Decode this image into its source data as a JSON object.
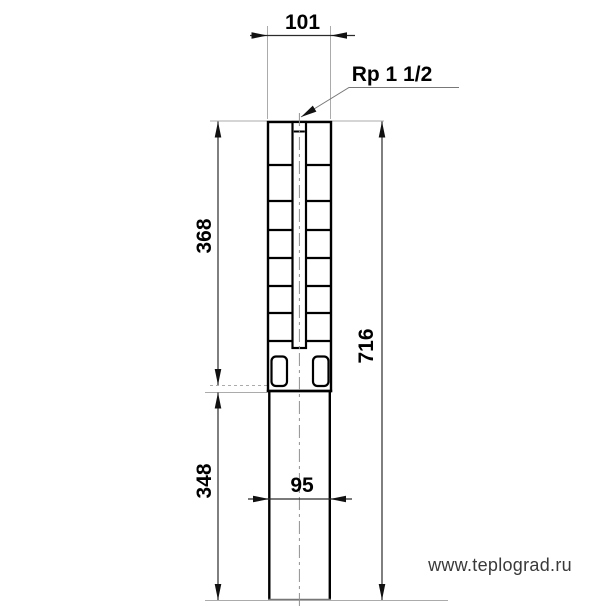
{
  "labels": {
    "top_width": "101",
    "connection": "Rp 1 1/2",
    "upper_height": "368",
    "lower_height": "348",
    "total_height": "716",
    "lower_width": "95"
  },
  "watermark": "www.teplograd.ru",
  "colors": {
    "body_line": "#000000",
    "dimension_line": "#2b2b2b",
    "extension_line": "#ababab",
    "centerline": "#909090",
    "text": "#000000",
    "watermark": "#3a3a3a",
    "background": "#ffffff"
  }
}
